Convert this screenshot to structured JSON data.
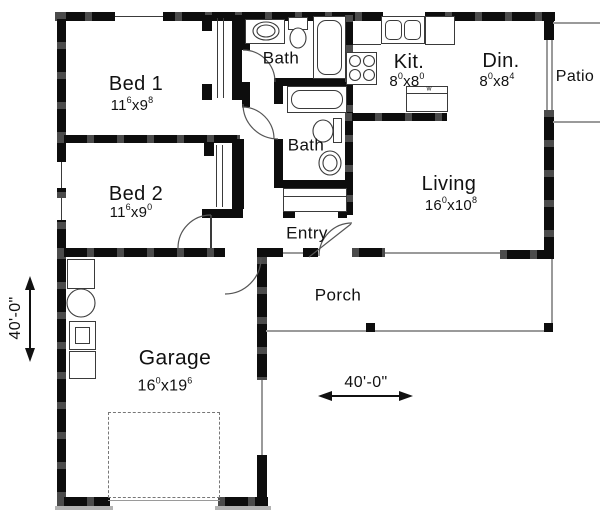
{
  "rooms": [
    {
      "label": "Bed 1",
      "dim": {
        "a": "11",
        "asup": "6",
        "sep": "x",
        "b": "9",
        "bsup": "8"
      }
    },
    {
      "label": "Bed 2",
      "dim": {
        "a": "11",
        "asup": "6",
        "sep": "x",
        "b": "9",
        "bsup": "0"
      }
    },
    {
      "label": "Bath"
    },
    {
      "label": "Bath"
    },
    {
      "label": "Kit.",
      "dim": {
        "a": "8",
        "asup": "0",
        "sep": "x",
        "b": "8",
        "bsup": "0"
      }
    },
    {
      "label": "Din.",
      "dim": {
        "a": "8",
        "asup": "0",
        "sep": "x",
        "b": "8",
        "bsup": "4"
      }
    },
    {
      "label": "Living",
      "dim": {
        "a": "16",
        "asup": "0",
        "sep": "x",
        "b": "10",
        "bsup": "8"
      }
    },
    {
      "label": "Entry"
    },
    {
      "label": "Porch"
    },
    {
      "label": "Patio"
    },
    {
      "label": "Garage",
      "dim": {
        "a": "16",
        "asup": "0",
        "sep": "x",
        "b": "19",
        "bsup": "6"
      }
    }
  ],
  "dimensions": {
    "overall_width": "40'-0\"",
    "overall_depth": "40'-0\""
  },
  "annotations": {
    "dishwasher": "w"
  },
  "colors": {
    "wall": "#0d0d0d",
    "fixture_line": "#3a3a3a",
    "porch_line": "#9a9a9a",
    "background": "#ffffff",
    "text": "#111111"
  },
  "fixtures": [
    "bathtub",
    "toilet",
    "sink-basin",
    "vanity-sink",
    "kitchen-double-sink",
    "range-stove",
    "refrigerator",
    "dishwasher-counter",
    "washer",
    "water-heater",
    "furnace",
    "garage-door-dashed",
    "porch-post"
  ]
}
